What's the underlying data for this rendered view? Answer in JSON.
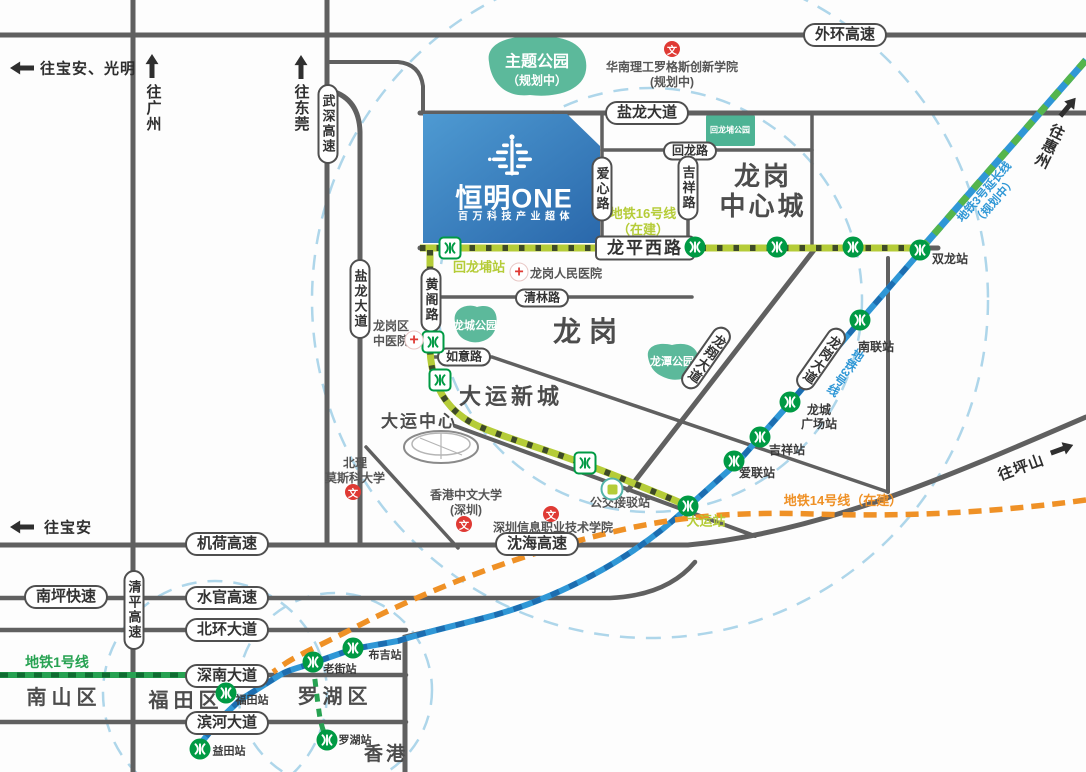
{
  "building": {
    "name": "恒明ONE",
    "tagline": "百万科技产业超体"
  },
  "colors": {
    "road": "#606060",
    "pill": "#4f4f4f",
    "ring": "#aed6ea",
    "park": "#5cb99b",
    "park2": "#4db394",
    "metro": "#009a44",
    "red": "#df3a34",
    "line16": "#b5cc38",
    "line16d": "#3e4a28",
    "line3": "#2f97d6",
    "line3d": "#1c6db0",
    "line3e": "#55b54c",
    "line14": "#ef9126",
    "line1": "#27a252",
    "line1d": "#0f6b31",
    "district": "#4c4c4c",
    "building_top": "#4e9ad2",
    "building_bottom": "#2a68ab"
  },
  "directions": [
    {
      "id": "to-baoan-guangming",
      "label": "往宝安、光明",
      "ax": 22,
      "ay": 68,
      "arot": -90,
      "tx": 88,
      "ty": 68,
      "vertical": false,
      "trot": 0
    },
    {
      "id": "to-guangzhou",
      "label": "往广州",
      "ax": 152,
      "ay": 66,
      "arot": 0,
      "tx": 153,
      "ty": 108,
      "vertical": true,
      "trot": 0
    },
    {
      "id": "to-dongguan",
      "label": "往东莞",
      "ax": 301,
      "ay": 67,
      "arot": 0,
      "tx": 301,
      "ty": 108,
      "vertical": true,
      "trot": 0
    },
    {
      "id": "to-huizhou",
      "label": "往惠州",
      "ax": 1068,
      "ay": 107,
      "arot": 40,
      "tx": 1049,
      "ty": 146,
      "vertical": true,
      "trot": 26
    },
    {
      "id": "to-pingshan",
      "label": "往坪山",
      "ax": 1062,
      "ay": 449,
      "arot": 70,
      "tx": 1021,
      "ty": 467,
      "vertical": false,
      "trot": -20
    },
    {
      "id": "to-baoan",
      "label": "往宝安",
      "ax": 22,
      "ay": 527,
      "arot": -90,
      "tx": 68,
      "ty": 527,
      "vertical": false,
      "trot": 0
    }
  ],
  "pills": [
    {
      "id": "waihuan-expressway",
      "label": "外环高速",
      "x": 845,
      "y": 35,
      "kind": "h"
    },
    {
      "id": "yanlong-avenue-h",
      "label": "盐龙大道",
      "x": 647,
      "y": 113,
      "kind": "h"
    },
    {
      "id": "huilong-road",
      "label": "回龙路",
      "x": 690,
      "y": 151,
      "kind": "s"
    },
    {
      "id": "longping-west-road",
      "label": "龙平西路",
      "x": 645,
      "y": 248,
      "kind": "sq"
    },
    {
      "id": "qinglin-road",
      "label": "清林路",
      "x": 542,
      "y": 298,
      "kind": "s"
    },
    {
      "id": "ruyi-road",
      "label": "如意路",
      "x": 464,
      "y": 357,
      "kind": "s"
    },
    {
      "id": "jihe-expressway",
      "label": "机荷高速",
      "x": 227,
      "y": 544,
      "kind": "h"
    },
    {
      "id": "shenhai-expressway",
      "label": "沈海高速",
      "x": 537,
      "y": 544,
      "kind": "h"
    },
    {
      "id": "nanping-expressway",
      "label": "南坪快速",
      "x": 66,
      "y": 597,
      "kind": "h"
    },
    {
      "id": "shuiguan-expressway",
      "label": "水官高速",
      "x": 227,
      "y": 598,
      "kind": "h"
    },
    {
      "id": "beihuan-avenue",
      "label": "北环大道",
      "x": 227,
      "y": 630,
      "kind": "h"
    },
    {
      "id": "shennan-avenue",
      "label": "深南大道",
      "x": 227,
      "y": 676,
      "kind": "h"
    },
    {
      "id": "binhe-avenue",
      "label": "滨河大道",
      "x": 227,
      "y": 723,
      "kind": "h"
    },
    {
      "id": "wushen-expressway",
      "label": "武深高速",
      "x": 328,
      "y": 124,
      "kind": "v"
    },
    {
      "id": "yanlong-avenue-v",
      "label": "盐龙大道",
      "x": 360,
      "y": 299,
      "kind": "v"
    },
    {
      "id": "huangge-road",
      "label": "黄阁路",
      "x": 431,
      "y": 300,
      "kind": "v"
    },
    {
      "id": "aixin-road",
      "label": "爱心路",
      "x": 602,
      "y": 189,
      "kind": "v"
    },
    {
      "id": "jixiang-road",
      "label": "吉祥路",
      "x": 688,
      "y": 188,
      "kind": "v"
    },
    {
      "id": "qingping-expressway",
      "label": "清平高速",
      "x": 134,
      "y": 610,
      "kind": "v"
    },
    {
      "id": "longxiang-avenue",
      "label": "龙翔大道",
      "x": 706,
      "y": 358,
      "kind": "r"
    },
    {
      "id": "longgang-avenue",
      "label": "龙岗大道",
      "x": 821,
      "y": 359,
      "kind": "r"
    }
  ],
  "districts": [
    {
      "id": "longgang-central-city",
      "lines": [
        "龙岗",
        "中心城"
      ],
      "x": 763,
      "y": 191,
      "size": 26,
      "ls": 3,
      "lh": 30
    },
    {
      "id": "longgang",
      "lines": [
        "龙岗"
      ],
      "x": 589,
      "y": 332,
      "size": 28,
      "ls": 8,
      "lh": 32
    },
    {
      "id": "dayun-new-town",
      "lines": [
        "大运新城"
      ],
      "x": 511,
      "y": 397,
      "size": 22,
      "ls": 4,
      "lh": 26
    },
    {
      "id": "dayun-center",
      "lines": [
        "大运中心"
      ],
      "x": 419,
      "y": 422,
      "size": 17,
      "ls": 2,
      "lh": 20
    },
    {
      "id": "nanshan-district",
      "lines": [
        "南山区"
      ],
      "x": 64,
      "y": 698,
      "size": 20,
      "ls": 5,
      "lh": 24
    },
    {
      "id": "futian-district",
      "lines": [
        "福田区"
      ],
      "x": 186,
      "y": 701,
      "size": 20,
      "ls": 5,
      "lh": 24
    },
    {
      "id": "luohu-district",
      "lines": [
        "罗湖区"
      ],
      "x": 335,
      "y": 697,
      "size": 20,
      "ls": 5,
      "lh": 24
    },
    {
      "id": "hongkong",
      "lines": [
        "香港"
      ],
      "x": 386,
      "y": 755,
      "size": 19,
      "ls": 3,
      "lh": 22
    }
  ],
  "parks": [
    {
      "id": "theme-park",
      "label": "主题公园",
      "sub": "（规划中）",
      "x": 537,
      "y": 68,
      "size": 16,
      "subsize": 12
    },
    {
      "id": "longcheng-park",
      "label": "龙城公园",
      "sub": "",
      "x": 475,
      "y": 325,
      "size": 11,
      "subsize": 0
    },
    {
      "id": "longtan-park",
      "label": "龙潭公园",
      "sub": "",
      "x": 672,
      "y": 361,
      "size": 11,
      "subsize": 0
    },
    {
      "id": "huilongpu-park",
      "label": "回龙埔公园",
      "sub": "",
      "x": 730,
      "y": 130,
      "size": 8,
      "subsize": 0
    }
  ],
  "line_labels": [
    {
      "id": "line16-label",
      "lines": [
        "地铁16号线",
        "（在建）"
      ],
      "x": 643,
      "y": 222,
      "color": "line16",
      "size": 13,
      "rot": 0,
      "vertical": false
    },
    {
      "id": "line1-label",
      "lines": [
        "地铁1号线"
      ],
      "x": 57,
      "y": 662,
      "color": "line1",
      "size": 14,
      "rot": 0,
      "vertical": false
    },
    {
      "id": "line14-label",
      "lines": [
        "地铁14号线（在建）"
      ],
      "x": 843,
      "y": 501,
      "color": "line14",
      "size": 13,
      "rot": 0,
      "vertical": false
    },
    {
      "id": "line3-label",
      "lines": [
        "地铁3号线"
      ],
      "x": 845,
      "y": 372,
      "color": "line3",
      "size": 12,
      "rot": 35,
      "vertical": true
    },
    {
      "id": "line3ext-label",
      "lines": [
        "地铁3号延长线",
        "（规划中）"
      ],
      "x": 990,
      "y": 197,
      "color": "line3",
      "size": 11.5,
      "rot": -49,
      "vertical": false
    }
  ],
  "stations": [
    {
      "id": "huilongpu-station",
      "lines": [
        "回龙埔站"
      ],
      "x": 450,
      "y": 248,
      "style": "sq",
      "lx": 479,
      "ly": 267,
      "lcolor": "line16",
      "lsize": 13
    },
    {
      "id": "shuanglong-station",
      "lines": [
        "双龙站"
      ],
      "x": 920,
      "y": 250,
      "style": "c",
      "lx": 950,
      "ly": 259,
      "lcolor": "",
      "lsize": 12
    },
    {
      "id": "nanlian-station",
      "lines": [
        "南联站"
      ],
      "x": 860,
      "y": 320,
      "style": "c",
      "lx": 876,
      "ly": 347,
      "lcolor": "",
      "lsize": 12
    },
    {
      "id": "longcheng-square-station",
      "lines": [
        "龙城",
        "广场站"
      ],
      "x": 790,
      "y": 402,
      "style": "c",
      "lx": 819,
      "ly": 417,
      "lcolor": "",
      "lsize": 12
    },
    {
      "id": "jixiang-station",
      "lines": [
        "吉祥站"
      ],
      "x": 760,
      "y": 437,
      "style": "c",
      "lx": 787,
      "ly": 450,
      "lcolor": "",
      "lsize": 12
    },
    {
      "id": "ailian-station",
      "lines": [
        "爱联站"
      ],
      "x": 734,
      "y": 461,
      "style": "c",
      "lx": 757,
      "ly": 473,
      "lcolor": "",
      "lsize": 12
    },
    {
      "id": "dayun-station",
      "lines": [
        "大运站"
      ],
      "x": 688,
      "y": 506,
      "style": "c",
      "lx": 706,
      "ly": 521,
      "lcolor": "line16",
      "lsize": 13
    },
    {
      "id": "buji-station",
      "lines": [
        "布吉站"
      ],
      "x": 353,
      "y": 648,
      "style": "c",
      "lx": 385,
      "ly": 656,
      "lcolor": "",
      "lsize": 11
    },
    {
      "id": "laojie-station",
      "lines": [
        "老街站"
      ],
      "x": 313,
      "y": 662,
      "style": "c",
      "lx": 340,
      "ly": 670,
      "lcolor": "",
      "lsize": 11
    },
    {
      "id": "futian-station",
      "lines": [
        "福田站"
      ],
      "x": 226,
      "y": 693,
      "style": "c",
      "lx": 252,
      "ly": 701,
      "lcolor": "",
      "lsize": 11
    },
    {
      "id": "yitian-station",
      "lines": [
        "益田站"
      ],
      "x": 200,
      "y": 749,
      "style": "c",
      "lx": 229,
      "ly": 752,
      "lcolor": "",
      "lsize": 11
    },
    {
      "id": "luohu-station",
      "lines": [
        "罗湖站"
      ],
      "x": 327,
      "y": 740,
      "style": "c",
      "lx": 355,
      "ly": 741,
      "lcolor": "",
      "lsize": 11
    }
  ],
  "stations_unlabeled": [
    {
      "x": 695,
      "y": 247,
      "style": "c"
    },
    {
      "x": 777,
      "y": 247,
      "style": "c"
    },
    {
      "x": 853,
      "y": 247,
      "style": "c"
    },
    {
      "x": 433,
      "y": 342,
      "style": "sq"
    },
    {
      "x": 440,
      "y": 380,
      "style": "sq"
    },
    {
      "x": 585,
      "y": 463,
      "style": "sq"
    }
  ],
  "pois": [
    {
      "id": "longgang-peoples-hospital",
      "icon": "cross",
      "lines": [
        "龙岗人民医院"
      ],
      "ix": 519,
      "iy": 272,
      "tx": 566,
      "ty": 274,
      "size": 12
    },
    {
      "id": "longgang-tcm-hospital",
      "icon": "cross",
      "lines": [
        "龙岗区",
        "中医院"
      ],
      "ix": 414,
      "iy": 340,
      "tx": 391,
      "ty": 334,
      "size": 12
    },
    {
      "id": "scut-rutgers-college",
      "icon": "wen",
      "lines": [
        "华南理工罗格斯创新学院",
        "(规划中)"
      ],
      "ix": 672,
      "iy": 49,
      "tx": 672,
      "ty": 75,
      "size": 12
    },
    {
      "id": "bit-moscow-university",
      "icon": "wen",
      "lines": [
        "北理",
        "莫斯科大学"
      ],
      "ix": 353,
      "iy": 492,
      "tx": 355,
      "ty": 471,
      "size": 12
    },
    {
      "id": "cuhk-shenzhen",
      "icon": "wen",
      "lines": [
        "香港中文大学",
        "(深圳)"
      ],
      "ix": 464,
      "iy": 524,
      "tx": 466,
      "ty": 503,
      "size": 12
    },
    {
      "id": "sz-info-tech-college",
      "icon": "wen",
      "lines": [
        "深圳信息职业技术学院"
      ],
      "ix": 551,
      "iy": 514,
      "tx": 553,
      "ty": 528,
      "size": 12
    },
    {
      "id": "bus-shuttle-stop",
      "icon": "bus",
      "lines": [
        "公交接驳站"
      ],
      "ix": 612,
      "iy": 489,
      "tx": 620,
      "ty": 503,
      "size": 12
    }
  ]
}
